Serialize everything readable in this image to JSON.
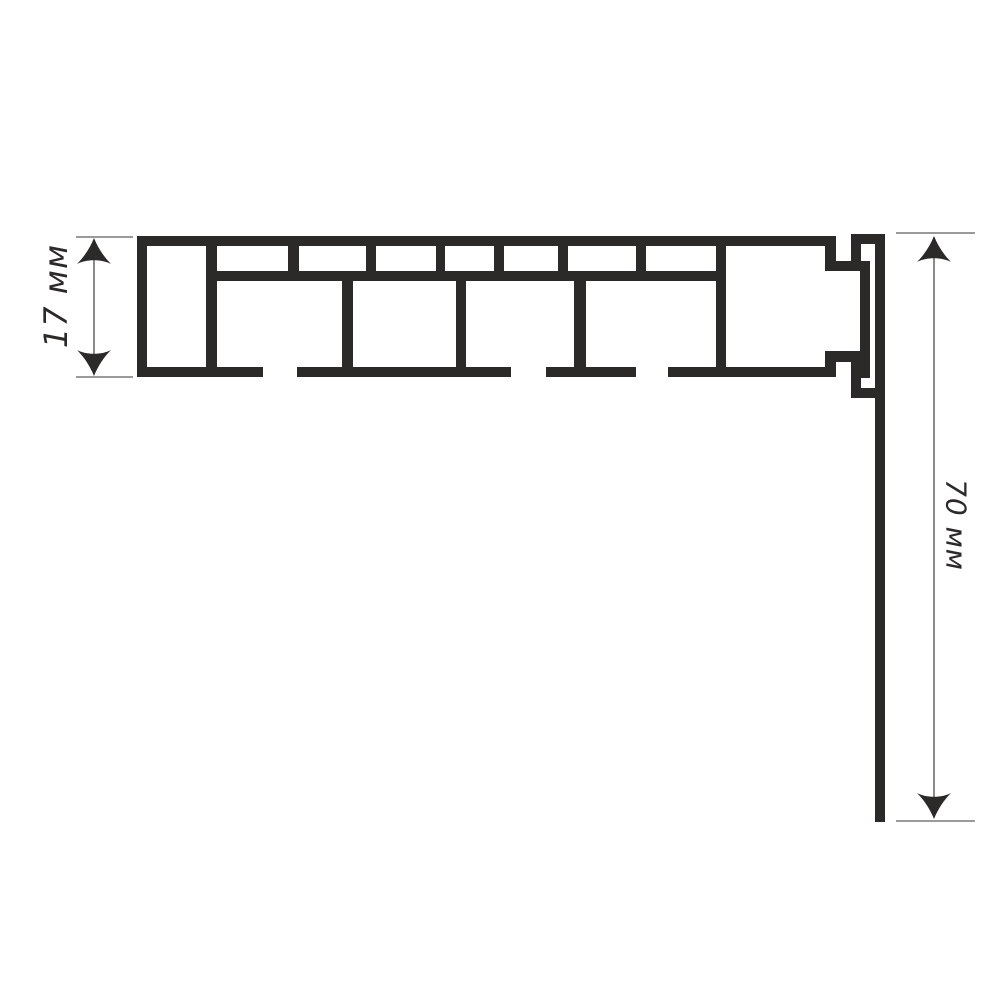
{
  "meta": {
    "description": "Technical line drawing: multi-chamber profile cross-section with height and apron-drop dimensions",
    "units": "мм"
  },
  "colors": {
    "background": "#ffffff",
    "profile": "#2b2a29",
    "dim_line": "#6e6e6e",
    "ext_line": "#8c8c8c",
    "arrow": "#2b2a29",
    "label": "#2b2a29"
  },
  "dimensions": [
    {
      "id": "profile-height",
      "label": "17 мм",
      "value": 17,
      "unit": "мм",
      "line": {
        "x": 94,
        "y1": 238,
        "y2": 376
      },
      "ext": [
        {
          "y": 237,
          "x1": 76,
          "x2": 133
        },
        {
          "y": 377,
          "x1": 76,
          "x2": 133
        }
      ],
      "label_pos": {
        "cx": 56,
        "cy": 296,
        "rotate": -90,
        "font_size": 32
      }
    },
    {
      "id": "apron-drop",
      "label": "70 мм",
      "value": 70,
      "unit": "мм",
      "line": {
        "x": 934,
        "y1": 236,
        "y2": 819
      },
      "ext": [
        {
          "y": 233,
          "x1": 896,
          "x2": 975
        },
        {
          "y": 821,
          "x1": 896,
          "x2": 975
        }
      ],
      "label_pos": {
        "cx": 956,
        "cy": 525,
        "rotate": 90,
        "font_size": 28
      }
    }
  ],
  "profile": {
    "rects": [
      {
        "name": "top-wall",
        "x": 137,
        "y": 236,
        "w": 699,
        "h": 10
      },
      {
        "name": "left-wall",
        "x": 137,
        "y": 236,
        "w": 10,
        "h": 141
      },
      {
        "name": "left-cell-divider",
        "x": 206,
        "y": 246,
        "w": 11,
        "h": 121
      },
      {
        "name": "mid-shelf",
        "x": 206,
        "y": 271,
        "w": 520,
        "h": 10
      },
      {
        "name": "top-row-rib-1",
        "x": 288,
        "y": 246,
        "w": 11,
        "h": 25
      },
      {
        "name": "top-row-rib-2",
        "x": 366,
        "y": 246,
        "w": 10,
        "h": 25
      },
      {
        "name": "top-row-rib-3",
        "x": 436,
        "y": 246,
        "w": 9,
        "h": 25
      },
      {
        "name": "top-row-rib-4",
        "x": 494,
        "y": 246,
        "w": 10,
        "h": 25
      },
      {
        "name": "top-row-rib-5",
        "x": 558,
        "y": 246,
        "w": 10,
        "h": 25
      },
      {
        "name": "top-row-rib-6",
        "x": 636,
        "y": 246,
        "w": 10,
        "h": 25
      },
      {
        "name": "bottom-row-rib-1",
        "x": 342,
        "y": 281,
        "w": 11,
        "h": 86
      },
      {
        "name": "bottom-row-rib-2",
        "x": 456,
        "y": 281,
        "w": 10,
        "h": 86
      },
      {
        "name": "bottom-row-rib-3",
        "x": 574,
        "y": 281,
        "w": 12,
        "h": 86
      },
      {
        "name": "right-cell-left-wall",
        "x": 716,
        "y": 246,
        "w": 10,
        "h": 121
      },
      {
        "name": "bottom-wall-seg-1",
        "x": 137,
        "y": 367,
        "w": 126,
        "h": 10
      },
      {
        "name": "bottom-wall-seg-2",
        "x": 297,
        "y": 367,
        "w": 214,
        "h": 10
      },
      {
        "name": "bottom-wall-seg-3",
        "x": 546,
        "y": 367,
        "w": 90,
        "h": 10
      },
      {
        "name": "bottom-wall-seg-4",
        "x": 668,
        "y": 367,
        "w": 168,
        "h": 10
      },
      {
        "name": "top-end-step",
        "x": 825,
        "y": 246,
        "w": 11,
        "h": 25
      },
      {
        "name": "top-hook-shelf",
        "x": 825,
        "y": 261,
        "w": 36,
        "h": 10
      },
      {
        "name": "top-hook-leg",
        "x": 851,
        "y": 244,
        "w": 10,
        "h": 27
      },
      {
        "name": "top-hook-cap",
        "x": 851,
        "y": 234,
        "w": 33,
        "h": 10
      },
      {
        "name": "inner-wall",
        "x": 860,
        "y": 261,
        "w": 10,
        "h": 117
      },
      {
        "name": "bottom-hook-shelf",
        "x": 825,
        "y": 351,
        "w": 36,
        "h": 11
      },
      {
        "name": "bottom-end-step",
        "x": 825,
        "y": 361,
        "w": 11,
        "h": 16
      },
      {
        "name": "bottom-hook-leg",
        "x": 851,
        "y": 361,
        "w": 10,
        "h": 29
      },
      {
        "name": "bottom-hook-cap",
        "x": 851,
        "y": 388,
        "w": 33,
        "h": 10
      },
      {
        "name": "apron-strip",
        "x": 875,
        "y": 234,
        "w": 10,
        "h": 588
      }
    ]
  }
}
